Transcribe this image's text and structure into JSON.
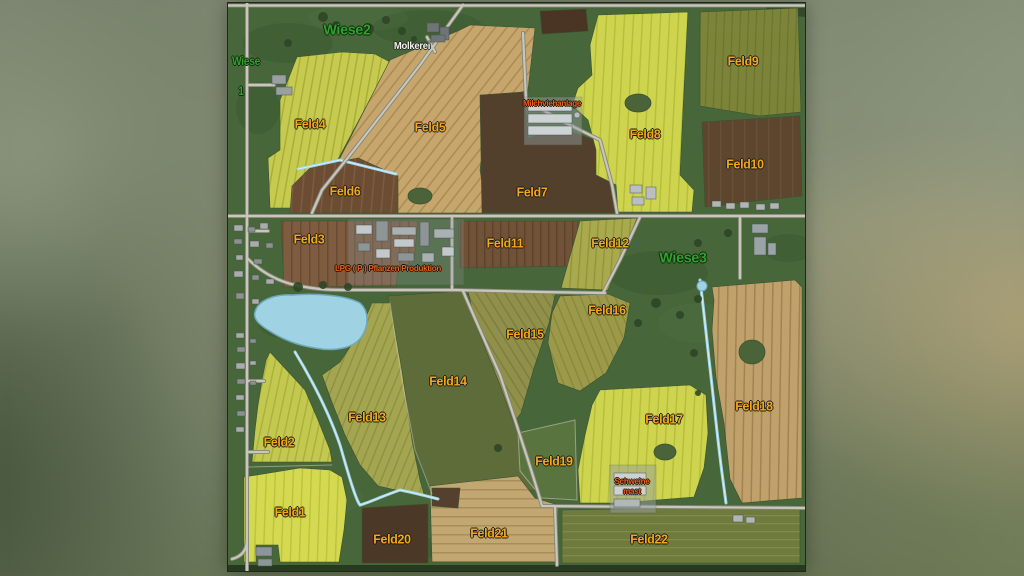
{
  "map": {
    "labels": {
      "wiese1_line1": "Wiese",
      "wiese1_line2": "1",
      "wiese2": "Wiese2",
      "wiese3": "Wiese3",
      "molkerei": "Molkerei",
      "milchviehanlage": "Milchviehanlage",
      "lpg": "LPG  ( P )  Pflanzen  Produktion",
      "schweinemast_line1": "Schweine",
      "schweinemast_line2": "mast",
      "feld1": "Feld1",
      "feld2": "Feld2",
      "feld3": "Feld3",
      "feld4": "Feld4",
      "feld5": "Feld5",
      "feld6": "Feld6",
      "feld7": "Feld7",
      "feld8": "Feld8",
      "feld9": "Feld9",
      "feld10": "Feld10",
      "feld11": "Feld11",
      "feld12": "Feld12",
      "feld13": "Feld13",
      "feld14": "Feld14",
      "feld15": "Feld15",
      "feld16": "Feld16",
      "feld17": "Feld17",
      "feld18": "Feld18",
      "feld19": "Feld19",
      "feld20": "Feld20",
      "feld21": "Feld21",
      "feld22": "Feld22"
    },
    "colors": {
      "label-yellow": "#f2a71e",
      "label-green": "#2da32d",
      "label-orange": "#e8611c",
      "label-white": "#f2f2ee",
      "road": "#c9c7b9",
      "road-casing": "#84857a",
      "water": "#9fd3e3",
      "water-light": "#d9eef6",
      "grass": "#47663a"
    }
  }
}
